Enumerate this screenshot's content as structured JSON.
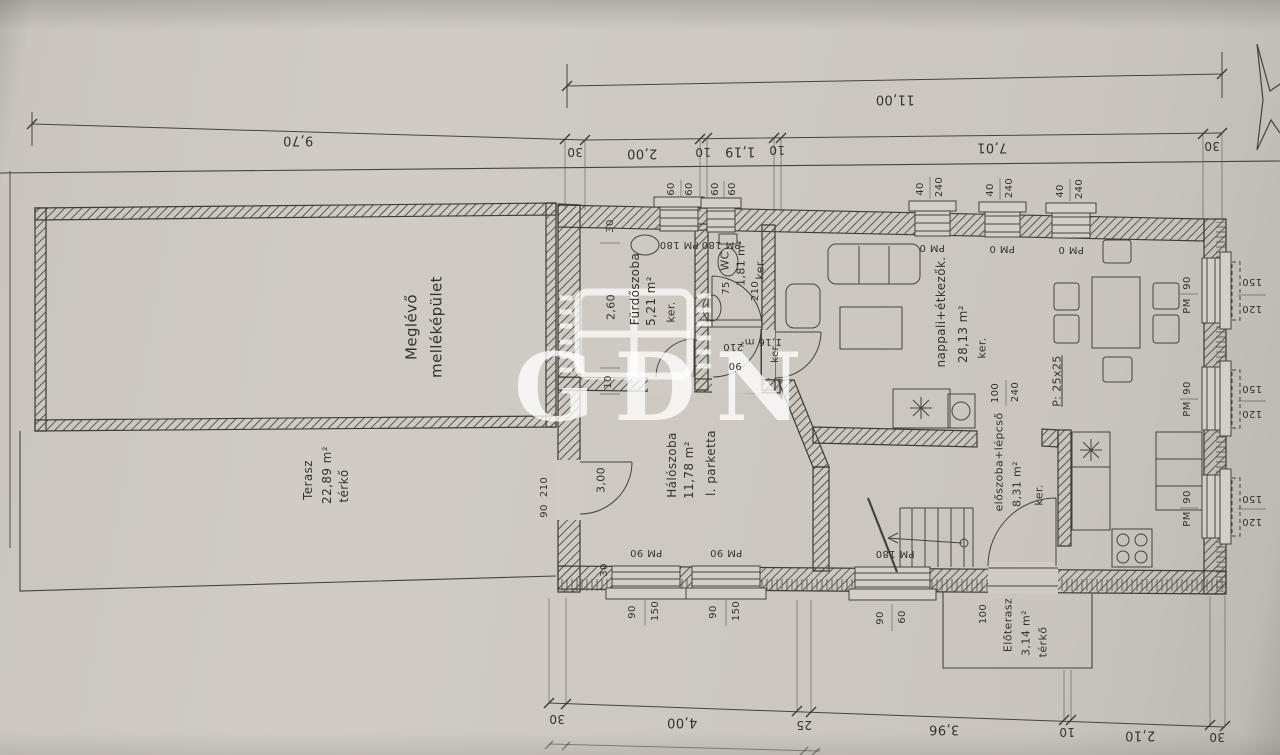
{
  "watermark": {
    "text": "GDN"
  },
  "labels": {
    "dimension_chains": [
      {
        "t": "11,00",
        "x": 895,
        "y": 99,
        "r": 180,
        "s": 13
      },
      {
        "t": "9,70",
        "x": 298,
        "y": 140,
        "r": 180,
        "s": 13
      },
      {
        "t": "30",
        "x": 575,
        "y": 152,
        "r": 180,
        "s": 12
      },
      {
        "t": "2,00",
        "x": 642,
        "y": 153,
        "r": 180,
        "s": 13
      },
      {
        "t": "10",
        "x": 703,
        "y": 152,
        "r": 180,
        "s": 12
      },
      {
        "t": "1,19",
        "x": 740,
        "y": 151,
        "r": 180,
        "s": 13
      },
      {
        "t": "10",
        "x": 777,
        "y": 150,
        "r": 180,
        "s": 12
      },
      {
        "t": "7,01",
        "x": 992,
        "y": 147,
        "r": 180,
        "s": 13
      },
      {
        "t": "30",
        "x": 1212,
        "y": 146,
        "r": 180,
        "s": 12
      },
      {
        "t": "30",
        "x": 557,
        "y": 719,
        "r": 180,
        "s": 12
      },
      {
        "t": "4,00",
        "x": 682,
        "y": 722,
        "r": 180,
        "s": 13
      },
      {
        "t": "25",
        "x": 804,
        "y": 725,
        "r": 180,
        "s": 12
      },
      {
        "t": "3,96",
        "x": 944,
        "y": 729,
        "r": 180,
        "s": 13
      },
      {
        "t": "10",
        "x": 1067,
        "y": 732,
        "r": 180,
        "s": 12
      },
      {
        "t": "2,10",
        "x": 1140,
        "y": 735,
        "r": 180,
        "s": 13
      },
      {
        "t": "30",
        "x": 1217,
        "y": 737,
        "r": 180,
        "s": 12
      }
    ],
    "window_marks": [
      {
        "t": "PM 180",
        "x": 679,
        "y": 244,
        "r": 180,
        "s": 10
      },
      {
        "t": "PM 180",
        "x": 721,
        "y": 244,
        "r": 180,
        "s": 10
      },
      {
        "t": "PM 0",
        "x": 932,
        "y": 247,
        "r": 180,
        "s": 10
      },
      {
        "t": "PM 0",
        "x": 1002,
        "y": 248,
        "r": 180,
        "s": 10
      },
      {
        "t": "PM 0",
        "x": 1071,
        "y": 249,
        "r": 180,
        "s": 10
      },
      {
        "t": "150",
        "x": 1252,
        "y": 281,
        "r": 180,
        "s": 10
      },
      {
        "t": "120",
        "x": 1252,
        "y": 308,
        "r": 180,
        "s": 10
      },
      {
        "t": "150",
        "x": 1252,
        "y": 388,
        "r": 180,
        "s": 10
      },
      {
        "t": "120",
        "x": 1252,
        "y": 413,
        "r": 180,
        "s": 10
      },
      {
        "t": "150",
        "x": 1252,
        "y": 498,
        "r": 180,
        "s": 10
      },
      {
        "t": "120",
        "x": 1252,
        "y": 521,
        "r": 180,
        "s": 10
      },
      {
        "t": "PM 90",
        "x": 646,
        "y": 552,
        "r": 180,
        "s": 10
      },
      {
        "t": "PM 90",
        "x": 726,
        "y": 552,
        "r": 180,
        "s": 10
      },
      {
        "t": "PM 180",
        "x": 895,
        "y": 553,
        "r": 180,
        "s": 10
      },
      {
        "t": "60",
        "x": 672,
        "y": 189,
        "r": -90,
        "s": 10
      },
      {
        "t": "60",
        "x": 690,
        "y": 189,
        "r": -90,
        "s": 10
      },
      {
        "t": "60",
        "x": 716,
        "y": 189,
        "r": -90,
        "s": 10
      },
      {
        "t": "60",
        "x": 733,
        "y": 189,
        "r": -90,
        "s": 10
      },
      {
        "t": "40",
        "x": 921,
        "y": 189,
        "r": -90,
        "s": 10
      },
      {
        "t": "240",
        "x": 940,
        "y": 187,
        "r": -90,
        "s": 10
      },
      {
        "t": "40",
        "x": 991,
        "y": 190,
        "r": -90,
        "s": 10
      },
      {
        "t": "240",
        "x": 1010,
        "y": 188,
        "r": -90,
        "s": 10
      },
      {
        "t": "40",
        "x": 1061,
        "y": 191,
        "r": -90,
        "s": 10
      },
      {
        "t": "240",
        "x": 1080,
        "y": 189,
        "r": -90,
        "s": 10
      },
      {
        "t": "90",
        "x": 1188,
        "y": 283,
        "r": -90,
        "s": 10
      },
      {
        "t": "PM",
        "x": 1188,
        "y": 306,
        "r": -90,
        "s": 10
      },
      {
        "t": "90",
        "x": 1188,
        "y": 388,
        "r": -90,
        "s": 10
      },
      {
        "t": "PM",
        "x": 1188,
        "y": 409,
        "r": -90,
        "s": 10
      },
      {
        "t": "90",
        "x": 1188,
        "y": 497,
        "r": -90,
        "s": 10
      },
      {
        "t": "PM",
        "x": 1188,
        "y": 519,
        "r": -90,
        "s": 10
      },
      {
        "t": "90",
        "x": 633,
        "y": 612,
        "r": -90,
        "s": 10
      },
      {
        "t": "150",
        "x": 656,
        "y": 611,
        "r": -90,
        "s": 10
      },
      {
        "t": "90",
        "x": 714,
        "y": 612,
        "r": -90,
        "s": 10
      },
      {
        "t": "150",
        "x": 737,
        "y": 611,
        "r": -90,
        "s": 10
      },
      {
        "t": "90",
        "x": 881,
        "y": 618,
        "r": -90,
        "s": 10
      },
      {
        "t": "60",
        "x": 903,
        "y": 617,
        "r": -90,
        "s": 10
      }
    ],
    "wall_dims": [
      {
        "t": "30",
        "x": 611,
        "y": 226,
        "r": -90,
        "s": 10
      },
      {
        "t": "2,60",
        "x": 611,
        "y": 307,
        "r": -90,
        "s": 11
      },
      {
        "t": "10",
        "x": 609,
        "y": 382,
        "r": -90,
        "s": 10
      },
      {
        "t": "3,00",
        "x": 601,
        "y": 480,
        "r": -90,
        "s": 11
      },
      {
        "t": "30",
        "x": 605,
        "y": 570,
        "r": -90,
        "s": 10
      },
      {
        "t": "210",
        "x": 545,
        "y": 487,
        "r": -90,
        "s": 10
      },
      {
        "t": "90",
        "x": 545,
        "y": 511,
        "r": -90,
        "s": 10
      },
      {
        "t": "75",
        "x": 727,
        "y": 288,
        "r": -90,
        "s": 10
      },
      {
        "t": "210",
        "x": 756,
        "y": 291,
        "r": -90,
        "s": 10
      },
      {
        "t": "100",
        "x": 984,
        "y": 614,
        "r": -90,
        "s": 10
      },
      {
        "t": "100",
        "x": 996,
        "y": 393,
        "r": -90,
        "s": 10
      },
      {
        "t": "240",
        "x": 1016,
        "y": 392,
        "r": -90,
        "s": 10
      },
      {
        "t": "210",
        "x": 733,
        "y": 346,
        "r": 180,
        "s": 10
      },
      {
        "t": "90",
        "x": 735,
        "y": 365,
        "r": 180,
        "s": 10
      }
    ],
    "rooms": [
      {
        "t": "Meglévő",
        "x": 412,
        "y": 327,
        "r": -90,
        "s": 15
      },
      {
        "t": "melléképület",
        "x": 437,
        "y": 327,
        "r": -90,
        "s": 15
      },
      {
        "t": "Terasz",
        "x": 308,
        "y": 480,
        "r": -90,
        "s": 12
      },
      {
        "t": "22,89 m²",
        "x": 327,
        "y": 475,
        "r": -90,
        "s": 12
      },
      {
        "t": "térkő",
        "x": 344,
        "y": 486,
        "r": -90,
        "s": 12
      },
      {
        "t": "Fürdőszoba",
        "x": 635,
        "y": 289,
        "r": -90,
        "s": 12
      },
      {
        "t": "5,21 m²",
        "x": 651,
        "y": 301,
        "r": -90,
        "s": 12
      },
      {
        "t": "ker.",
        "x": 671,
        "y": 312,
        "r": -90,
        "s": 11
      },
      {
        "t": "WC",
        "x": 725,
        "y": 261,
        "r": -90,
        "s": 11
      },
      {
        "t": "1,81 m²",
        "x": 741,
        "y": 263,
        "r": -90,
        "s": 11
      },
      {
        "t": "ker.",
        "x": 760,
        "y": 269,
        "r": -90,
        "s": 11
      },
      {
        "t": "1,16 m²",
        "x": 761,
        "y": 341,
        "r": 180,
        "s": 10
      },
      {
        "t": "ker.",
        "x": 776,
        "y": 353,
        "r": -90,
        "s": 10
      },
      {
        "t": "Hálószoba",
        "x": 672,
        "y": 465,
        "r": -90,
        "s": 12
      },
      {
        "t": "11,78 m²",
        "x": 689,
        "y": 470,
        "r": -90,
        "s": 12
      },
      {
        "t": "l. parketta",
        "x": 711,
        "y": 463,
        "r": -90,
        "s": 12
      },
      {
        "t": "nappali+étkezők.",
        "x": 941,
        "y": 312,
        "r": -90,
        "s": 12
      },
      {
        "t": "28,13 m²",
        "x": 963,
        "y": 334,
        "r": -90,
        "s": 12
      },
      {
        "t": "ker.",
        "x": 982,
        "y": 348,
        "r": -90,
        "s": 11
      },
      {
        "t": "előszoba+lépcső",
        "x": 999,
        "y": 462,
        "r": -90,
        "s": 11
      },
      {
        "t": "8,31 m²",
        "x": 1017,
        "y": 484,
        "r": -90,
        "s": 11
      },
      {
        "t": "ker.",
        "x": 1039,
        "y": 495,
        "r": -90,
        "s": 11
      },
      {
        "t": "Előterasz",
        "x": 1008,
        "y": 625,
        "r": -90,
        "s": 11
      },
      {
        "t": "3,14 m²",
        "x": 1026,
        "y": 633,
        "r": -90,
        "s": 11
      },
      {
        "t": "térkő",
        "x": 1043,
        "y": 642,
        "r": -90,
        "s": 11
      },
      {
        "t": "P: 25x25",
        "x": 1057,
        "y": 381,
        "r": -90,
        "s": 11,
        "u": true
      }
    ]
  }
}
